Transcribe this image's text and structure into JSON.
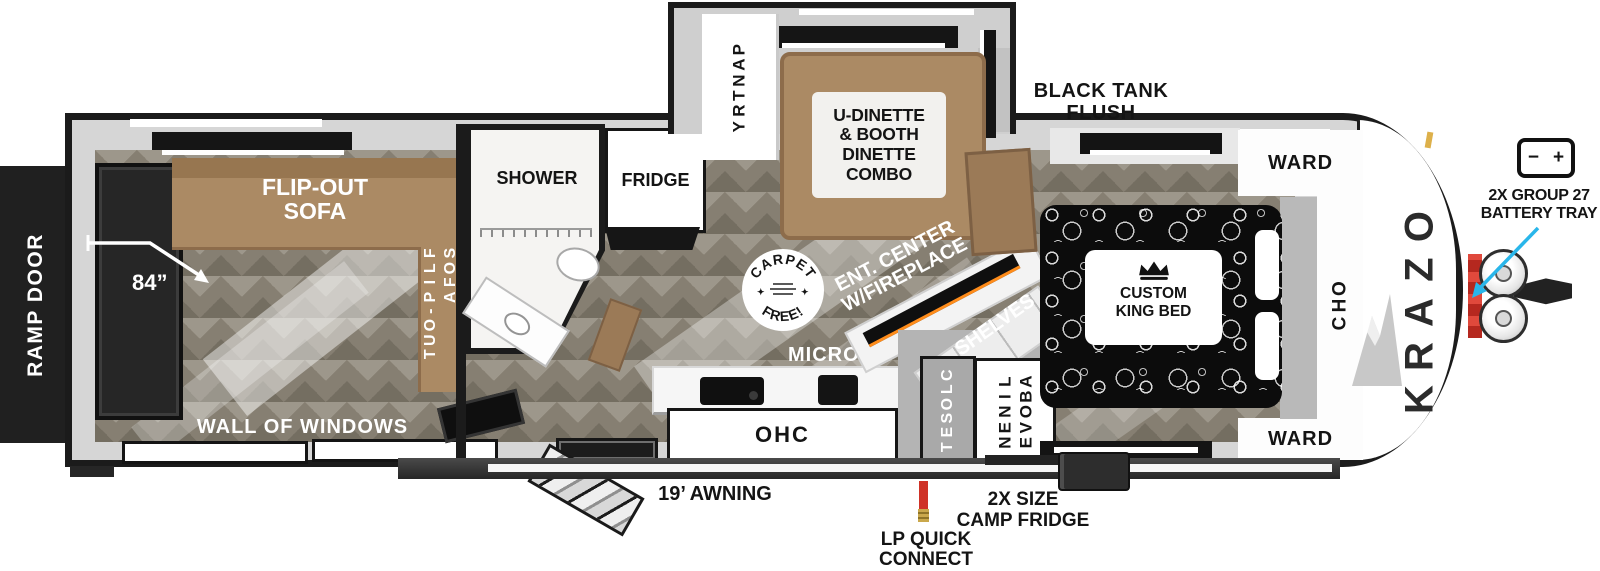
{
  "labels": {
    "ramp_door": "RAMP DOOR",
    "dim_84": "84”",
    "flip_out_sofa_top": "FLIP-OUT\nSOFA",
    "flip_out_sofa_side": "FLIP-OUT\nSOFA",
    "wall_of_windows": "WALL OF WINDOWS",
    "shower": "SHOWER",
    "fridge": "FRIDGE",
    "pantry": "PANTRY",
    "dinette": "U-DINETTE\n& BOOTH\nDINETTE\nCOMBO",
    "black_tank_flush": "BLACK TANK\nFLUSH",
    "carpet_free_top": "CARPET",
    "carpet_free_bottom": "FREE!",
    "ent_center": "ENT. CENTER\nW/FIREPLACE",
    "shelves": "SHELVES",
    "micro": "MICRO",
    "ohc_kitchen": "OHC",
    "closet": "CLOSET",
    "linen_above": "LINEN\nABOVE",
    "custom_king_bed": "CUSTOM\nKING BED",
    "ward_top": "WARD",
    "ward_bottom": "WARD",
    "ohc_bedroom": "OHC",
    "brand": "OZARK",
    "battery_tray": "2X GROUP 27\nBATTERY TRAY",
    "battery_minus": "−",
    "battery_plus": "+",
    "awning": "19’ AWNING",
    "lp_quick_connect": "LP QUICK\nCONNECT",
    "camp_fridge": "2X SIZE\nCAMP FRIDGE"
  },
  "colors": {
    "outline": "#1b1b1b",
    "wall_gray": "#d6d6d6",
    "floor": "#867f72",
    "sofa_brown": "#ab8a64",
    "accent_arrow": "#29b6ea",
    "lp_connector": "#cf3227",
    "bed_black": "#0c0c0c"
  }
}
